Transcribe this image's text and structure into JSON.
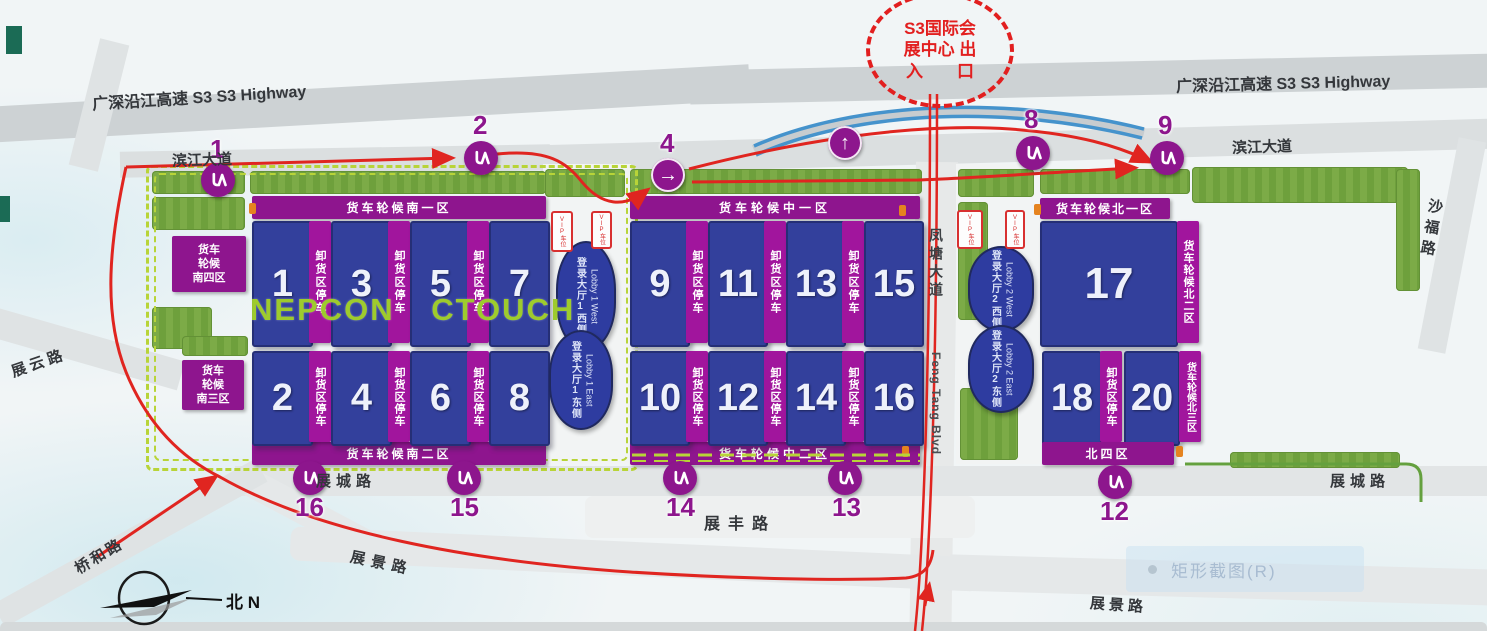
{
  "entrance_circle": {
    "line1": "S3国际会",
    "line2": "展中心 出",
    "line3": "入　　口"
  },
  "roads": {
    "highway": "广深沿江高速 S3  S3 Highway",
    "binjiang": "滨江大道",
    "shafu": "沙福路",
    "fengtang_cn": "凤塘大道",
    "fengtang_en": "Feng Tang Blvd",
    "zhanyun": "展云路",
    "qiaohe": "桥和路",
    "zhancheng": "展城路",
    "zhanfeng": "展丰路",
    "zhanjing": "展景路"
  },
  "south": {
    "banner_top": "货车轮候南一区",
    "banner_bottom": "货车轮候南二区",
    "box_s4": [
      "货车",
      "轮候",
      "南四区"
    ],
    "box_s3": [
      "货车",
      "轮候",
      "南三区"
    ],
    "halls_top": [
      "1",
      "3",
      "5",
      "7"
    ],
    "halls_bottom": [
      "2",
      "4",
      "6",
      "8"
    ]
  },
  "mid": {
    "banner_top": "货车轮候中一区",
    "banner_bottom": "货车轮候中二区",
    "halls_top": [
      "9",
      "11",
      "13",
      "15"
    ],
    "halls_bottom": [
      "10",
      "12",
      "14",
      "16"
    ]
  },
  "north": {
    "banner_top": "货车轮候北一区",
    "banner_bottom": "北四区",
    "strip_ne": "货车轮候北二区",
    "strip_se": "货车轮候北三区",
    "hall17": "17",
    "halls_bottom": [
      "18",
      "20"
    ]
  },
  "unload_strip": "卸货区停车",
  "lobbies": {
    "l1w_cn": "登录大厅1西侧",
    "l1w_en": "Lobby 1 West",
    "l1e_cn": "登录大厅1东侧",
    "l1e_en": "Lobby 1 East",
    "l2w_cn": "登录大厅2西侧",
    "l2w_en": "Lobby 2 West",
    "l2e_cn": "登录大厅2东侧",
    "l2e_en": "Lobby 2 East"
  },
  "markers": {
    "m1": "1",
    "m2": "2",
    "m4": "4",
    "m8": "8",
    "m9": "9",
    "m12": "12",
    "m13": "13",
    "m14": "14",
    "m15": "15",
    "m16": "16"
  },
  "vip_label": "VIP车位",
  "watermark": "NEPCON  CTOUCH",
  "compass_label": "北 N",
  "overlay_tooltip": "矩形截图(R)",
  "colors": {
    "hall_blue": "#33409c",
    "banner_purple": "#8e158e",
    "strip_purple": "#a1159d",
    "route_red": "#e02520",
    "flyover_blue": "#4593cc",
    "metro_purple": "#8d168d",
    "lawn_green": "#79ad4c",
    "boundary_green": "#b5d437",
    "watermark_green": "#9ecb2d"
  }
}
